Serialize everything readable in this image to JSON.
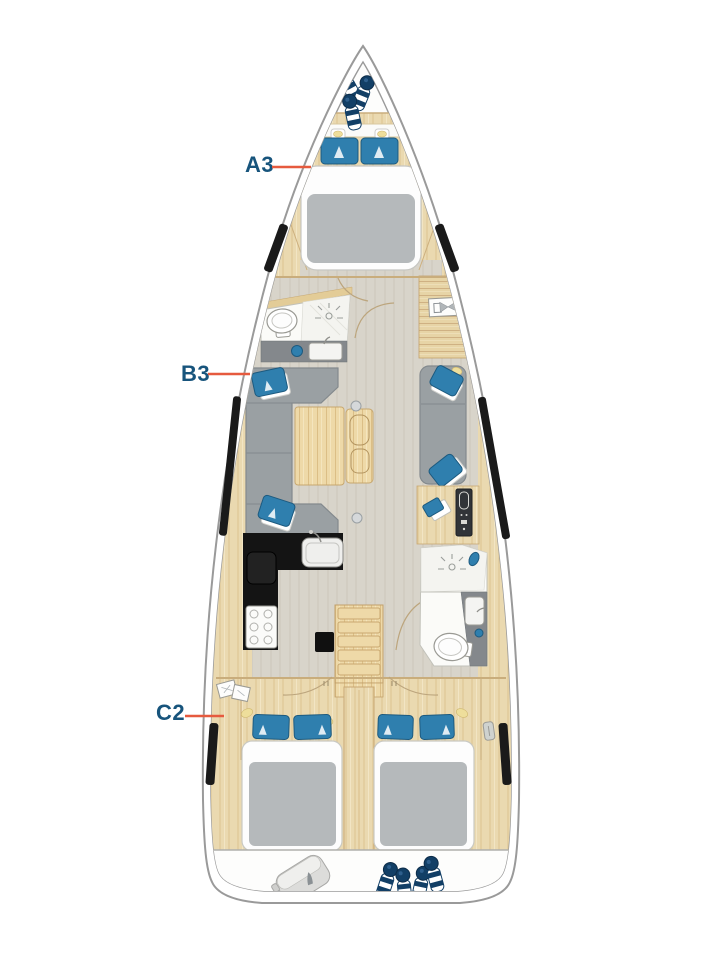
{
  "diagram": {
    "type": "sailing-yacht-interior-layout-top-view",
    "labels": [
      {
        "text": "A3",
        "target": "forward-cabin-double-berth"
      },
      {
        "text": "B3",
        "target": "saloon-port-sofa-berth"
      },
      {
        "text": "C2",
        "target": "aft-port-cabin-double-berth"
      }
    ],
    "colors": {
      "label_text": "#17547c",
      "leader_line": "#e65a3e",
      "hull_outline": "#9a9a9a",
      "wood": "#ead9b0",
      "floor_gray": "#d8d4ca",
      "upholstery_gray": "#9aa0a3",
      "pillow_blue": "#2f7fae",
      "window_black": "#1a1a1a",
      "galley_counter_black": "#141414",
      "fender_navy": "#123f66",
      "mattress_gray": "#b5b9bb",
      "vanity_gray": "#84888c",
      "lamp_yellow": "#eede9b"
    }
  }
}
